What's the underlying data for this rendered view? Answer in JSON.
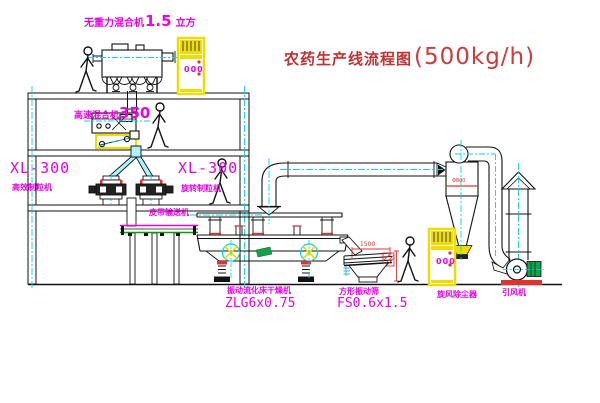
{
  "title": {
    "name_cn": "农药生产线流程图",
    "capacity": "(500kg/h)"
  },
  "equipment": {
    "gravity_mixer": {
      "name": "无重力混合机",
      "size": "1.5",
      "unit": "立方"
    },
    "high_speed_mixer": {
      "name": "高速混合机",
      "model": "350"
    },
    "granulator_left": {
      "model": "XL-300",
      "name": "高效制粒机"
    },
    "granulator_right": {
      "model": "XL-300",
      "name": "旋转制粒机"
    },
    "belt_conveyor": {
      "name": "皮带输送机"
    },
    "fluid_bed_dryer": {
      "name": "振动流化床干燥机",
      "model": "ZLG6x0.75"
    },
    "vibrating_screen": {
      "name": "方形振动筛",
      "model": "FS0.6x1.5"
    },
    "cyclone": {
      "name": "旋风除尘器"
    },
    "fan": {
      "name": "引风机"
    }
  },
  "dimensions": {
    "screen_length": "1500",
    "cyclone_dia": "Φ800"
  },
  "control_cabinet": {
    "display": "000"
  },
  "colors": {
    "label_magenta": "#e800e8",
    "title_red": "#c23030",
    "centerline_cyan": "#00d9e0",
    "cabinet_yellow": "#f0dc00",
    "accent_red": "#e33030",
    "motor_green": "#15a04c",
    "conveyor_green": "#00a000"
  }
}
